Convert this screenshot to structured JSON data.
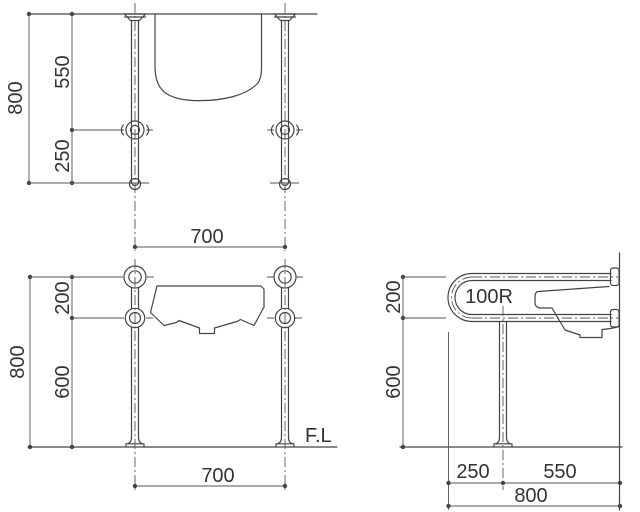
{
  "drawing": {
    "background_color": "#ffffff",
    "line_color": "#444444",
    "text_color": "#333333",
    "views": {
      "plan": {
        "dim_depth_total": "800",
        "dim_depth_upper": "550",
        "dim_depth_lower": "250",
        "dim_width": "700"
      },
      "front": {
        "dim_height_total": "800",
        "dim_height_upper": "200",
        "dim_height_lower": "600",
        "dim_width": "700",
        "floor_line_label": "F.L"
      },
      "side": {
        "dim_height_upper": "200",
        "dim_height_lower": "600",
        "bend_radius_label": "100R",
        "dim_front": "250",
        "dim_rear": "550",
        "dim_depth_total": "800"
      }
    }
  }
}
